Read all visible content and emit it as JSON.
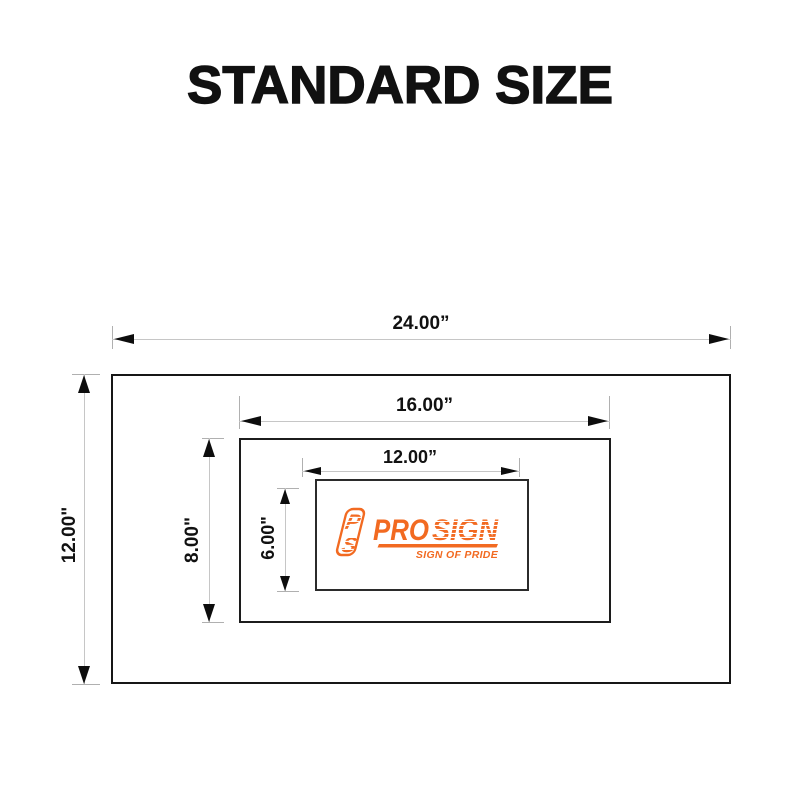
{
  "title": "STANDARD SIZE",
  "colors": {
    "accent_orange": "#F26A21",
    "ink": "#111111",
    "dimension_line": "#C6C6C6"
  },
  "diagram": {
    "outer": {
      "width_label": "24.00”",
      "height_label": "12.00\""
    },
    "middle": {
      "width_label": "16.00”",
      "height_label": "8.00\""
    },
    "inner": {
      "width_label": "12.00”",
      "height_label": "6.00\""
    }
  },
  "logo": {
    "monogram_p": "P",
    "monogram_s": "S",
    "brand_pro": "PRO",
    "brand_sign": "SIGN",
    "tagline": "SIGN OF PRIDE"
  }
}
